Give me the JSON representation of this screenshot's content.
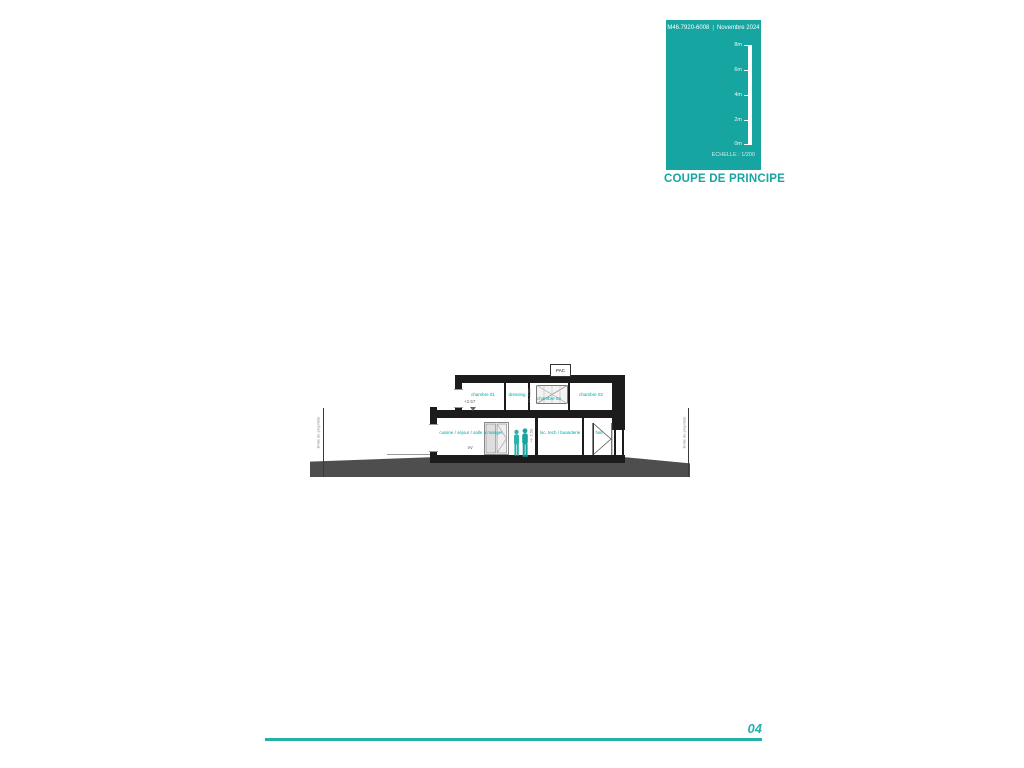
{
  "title_block": {
    "header_ref": "M46.7920-6008",
    "header_sep": "|",
    "header_date": "Novembre 2024",
    "scale_ticks": [
      "8m",
      "6m",
      "4m",
      "2m",
      "0m"
    ],
    "scale_label": "ECHELLE : 1/200",
    "title": "COUPE DE PRINCIPE",
    "accent_color": "#16a5a0"
  },
  "drawing": {
    "pac_label": "PAC",
    "upper_rooms": [
      {
        "label": "chambre 01"
      },
      {
        "label": "dressing"
      },
      {
        "label": "chambre 03"
      },
      {
        "label": "chambre 02"
      }
    ],
    "ground_rooms": [
      {
        "label": "cuisine / séjour / salle à manger"
      },
      {
        "label": "loc. tech / buanderie"
      },
      {
        "label": "hall"
      }
    ],
    "upper_level_marker": "+2.57",
    "upper_height_dim": "+/- 2.50",
    "ground_height_dim": "+/- 2.50",
    "property_limit_left": "limite de propriété",
    "property_limit_right": "limite de propriété",
    "colors": {
      "structure": "#1c1c1c",
      "terrain": "#4e4e4e",
      "room_label": "#00a5a5",
      "figures": "#2bb3ab"
    }
  },
  "footer": {
    "page_number": "04"
  }
}
